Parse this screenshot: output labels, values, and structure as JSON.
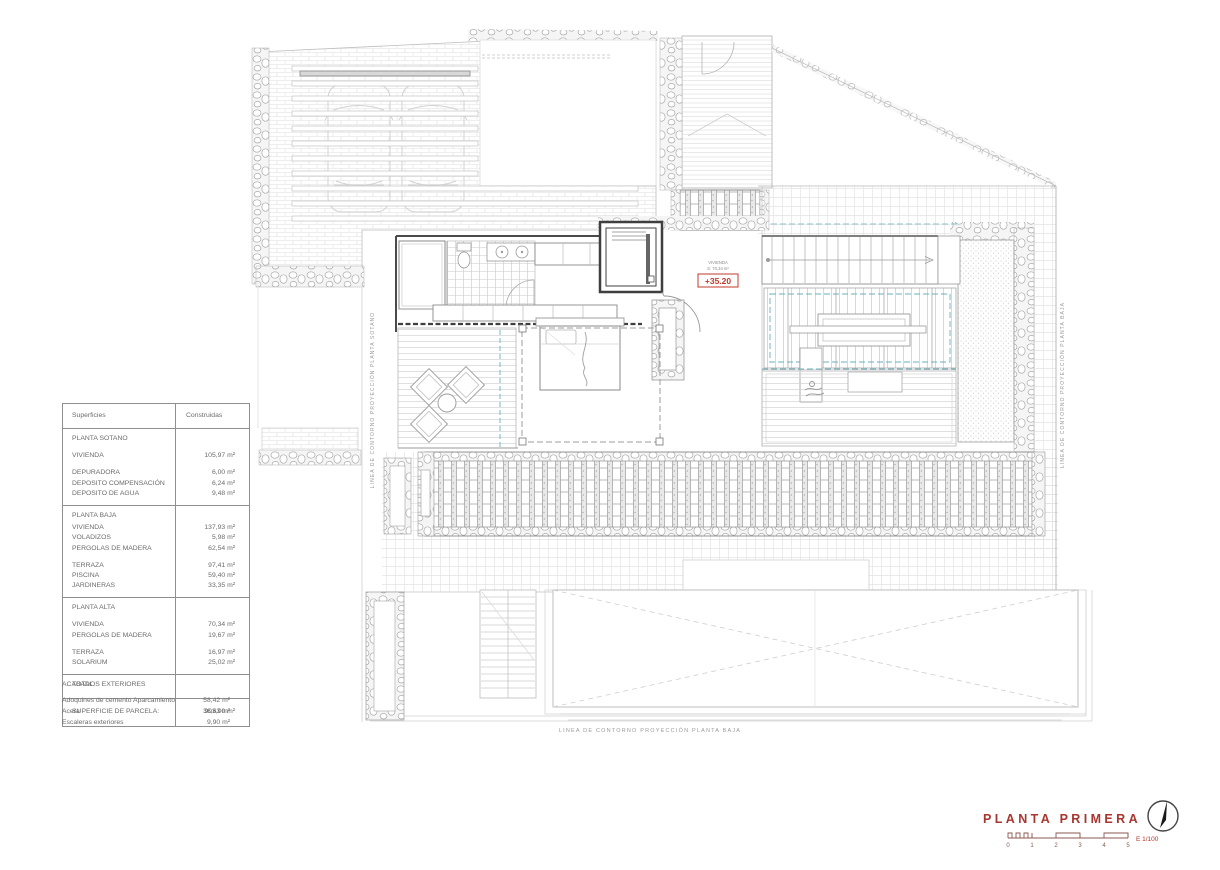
{
  "plan": {
    "title": "PLANTA PRIMERA",
    "scale_label": "E 1/100",
    "scale_ticks": [
      "0",
      "1",
      "2",
      "3",
      "4",
      "5"
    ],
    "level_mark": "+35.20",
    "room_label": [
      "VIVIENDA",
      "S: 70,34 m²"
    ],
    "captions": {
      "bottom": "LINEA DE CONTORNO PROYECCIÓN PLANTA BAJA",
      "left": "LINEA DE CONTORNO PROYECCIÓN PLANTA SOTANO",
      "right": "LINEA DE CONTORNO PROYECCIÓN PLANTA BAJA"
    }
  },
  "colors": {
    "accent_red": "#a8352e",
    "level_red": "#c0392b",
    "dashed_teal": "#6ab0ba"
  },
  "table": {
    "headers": {
      "col1": "Superficies",
      "col2": "Construidas"
    },
    "sections": [
      [
        [
          "PLANTA SOTANO",
          "",
          "title"
        ],
        [
          "VIVIENDA",
          "105,97 m²",
          "sp"
        ],
        [
          "DEPURADORA",
          "6,00 m²",
          "sp"
        ],
        [
          "DEPOSITO COMPENSACIÓN",
          "6,24 m²",
          ""
        ],
        [
          "DEPOSITO DE AGUA",
          "9,48 m²",
          ""
        ]
      ],
      [
        [
          "PLANTA BAJA",
          "",
          "title"
        ],
        [
          "VIVIENDA",
          "137,93 m²",
          ""
        ],
        [
          "VOLADIZOS",
          "5,98 m²",
          ""
        ],
        [
          "PERGOLAS DE MADERA",
          "62,54 m²",
          ""
        ],
        [
          "TERRAZA",
          "97,41 m²",
          "sp"
        ],
        [
          "PISCINA",
          "59,40 m²",
          ""
        ],
        [
          "JARDINERAS",
          "33,35 m²",
          ""
        ]
      ],
      [
        [
          "PLANTA ALTA",
          "",
          "title"
        ],
        [
          "VIVIENDA",
          "70,34 m²",
          "sp"
        ],
        [
          "PERGOLAS DE MADERA",
          "19,67 m²",
          ""
        ],
        [
          "TERRAZA",
          "16,97 m²",
          "sp"
        ],
        [
          "SOLARIUM",
          "25,02 m²",
          ""
        ]
      ],
      [
        [
          "TOTAL",
          "",
          "title"
        ]
      ],
      [
        [
          "SUPERFICIE DE PARCELA:",
          "903,00 m²",
          ""
        ]
      ]
    ],
    "exteriors": {
      "title": "ACABADOS EXTERIORES",
      "rows": [
        [
          "Adoquines de cemento Aparcamiento",
          "58,42 m²"
        ],
        [
          "Acera",
          "36,63 m²"
        ],
        [
          "Escaleras exteriores",
          "9,90 m²"
        ]
      ]
    }
  }
}
